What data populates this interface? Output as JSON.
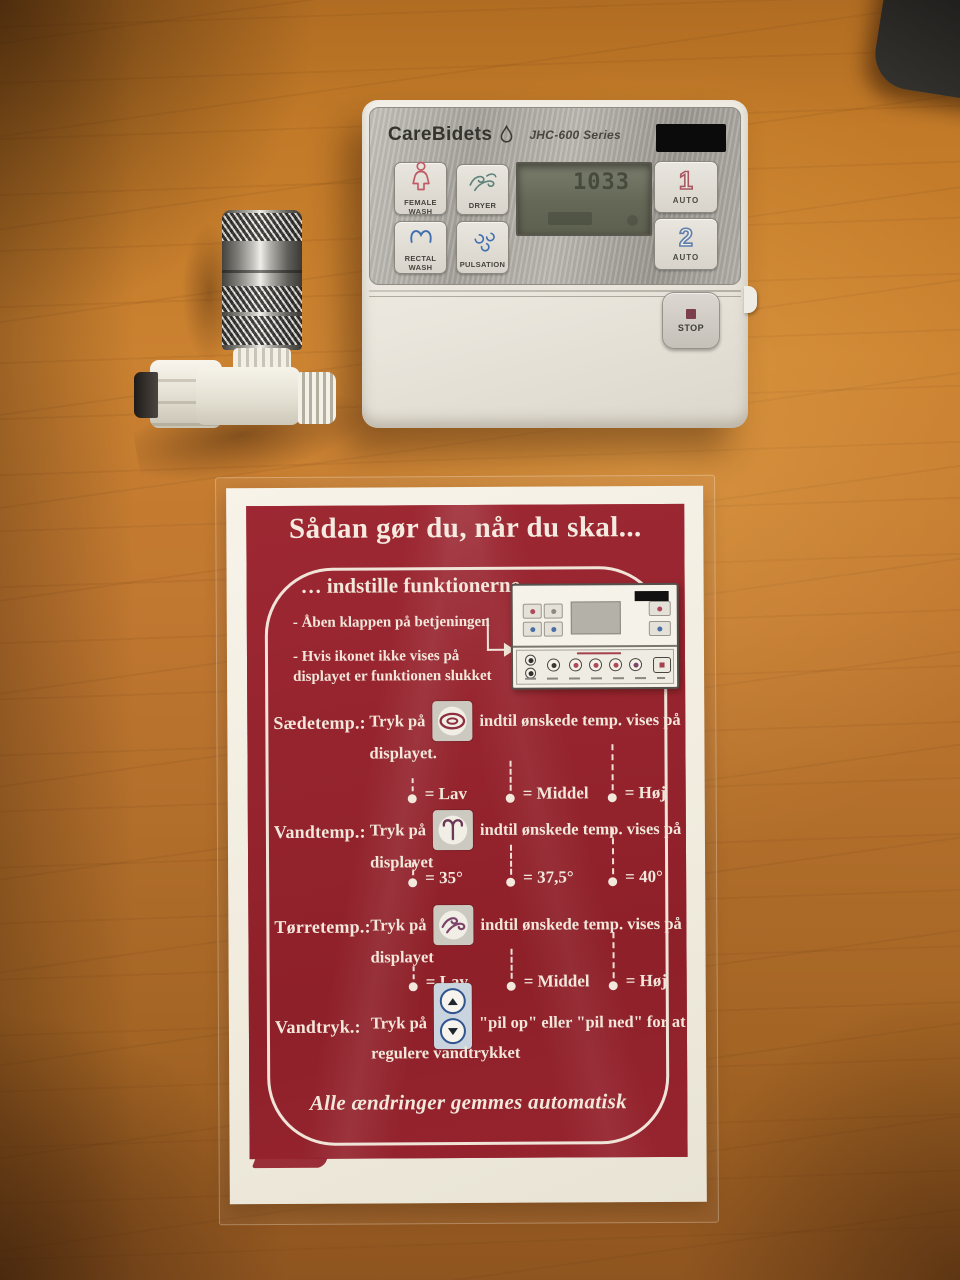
{
  "device": {
    "brand": "CareBidets",
    "model": "JHC-600 Series",
    "display": "1033",
    "buttons": [
      {
        "label": "FEMALE WASH",
        "icon": "female-wash-icon"
      },
      {
        "label": "DRYER",
        "icon": "dryer-wind-icon"
      },
      {
        "label": "RECTAL WASH",
        "icon": "rectal-wash-icon"
      },
      {
        "label": "PULSATION",
        "icon": "pulsation-swirls-icon"
      }
    ],
    "presets": [
      {
        "digit": "1",
        "label": "AUTO"
      },
      {
        "digit": "2",
        "label": "AUTO"
      }
    ],
    "stop_label": "STOP"
  },
  "card": {
    "title": "Sådan gør du, når du skal...",
    "subtitle": "… indstille funktionerne",
    "bullet1": "- Åben klappen på betjeningen",
    "bullet2": "- Hvis ikonet ikke vises på displayet er funktionen slukket",
    "rows": [
      {
        "label": "Sædetemp.:",
        "pre": "Tryk på",
        "post": "indtil ønskede temp. vises på",
        "line2": "displayet.",
        "icon": "seat-temperature-icon",
        "levels": [
          {
            "label": "= Lav"
          },
          {
            "label": "= Middel"
          },
          {
            "label": "= Høj"
          }
        ]
      },
      {
        "label": "Vandtemp.:",
        "pre": "Tryk på",
        "post": "indtil ønskede temp. vises på",
        "line2": "displayet",
        "icon": "water-temperature-icon",
        "levels": [
          {
            "label": "= 35°"
          },
          {
            "label": "= 37,5°"
          },
          {
            "label": "= 40°"
          }
        ]
      },
      {
        "label": "Tørretemp.:",
        "pre": "Tryk på",
        "post": "indtil ønskede temp. vises på",
        "line2": "displayet",
        "icon": "dryer-temperature-icon",
        "levels": [
          {
            "label": "= Lav"
          },
          {
            "label": "= Middel"
          },
          {
            "label": "= Høj"
          }
        ]
      },
      {
        "label": "Vandtryk.:",
        "pre": "Tryk på",
        "post": "\"pil op\" eller \"pil ned\" for at",
        "line2": "regulere vandtrykket",
        "icon": "water-pressure-arrows-icon",
        "levels": []
      }
    ],
    "footer": "Alle ændringer gemmes automatisk"
  },
  "colors": {
    "card_red": "#96242f",
    "card_text": "#f2e7da",
    "accent_blue": "#3f6fb0",
    "accent_pink": "#c05b66",
    "accent_teal": "#5f837b",
    "accent_purple": "#7b4468",
    "metal": "#b3b0a9"
  }
}
